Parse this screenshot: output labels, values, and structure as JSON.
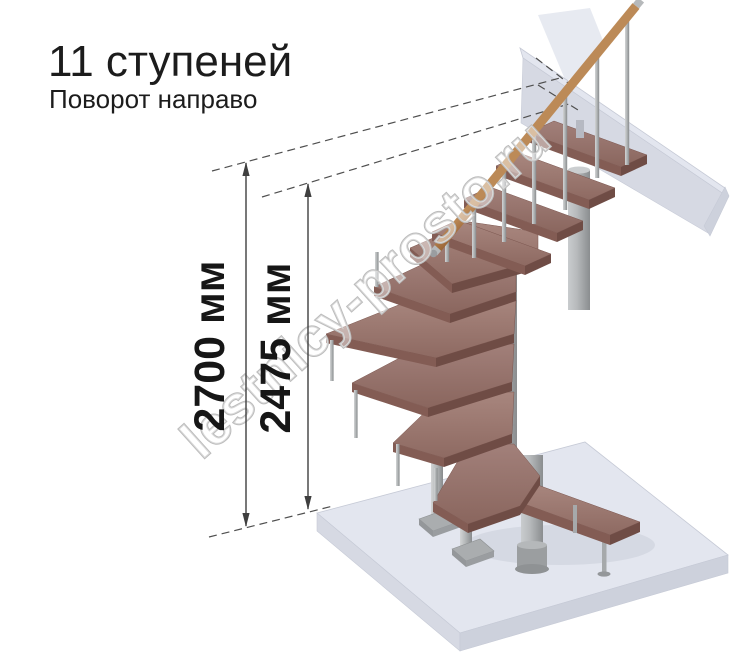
{
  "header": {
    "title": "11 ступеней",
    "subtitle": "Поворот направо"
  },
  "annotations": {
    "dimension_outer": "2700 мм",
    "dimension_inner": "2475 мм"
  },
  "watermark": "lestnicy-prosto.ru",
  "colors": {
    "wood_top": "#9a7871",
    "wood_edge": "#7d5750",
    "metal": "#b4b6b8",
    "floor_slab": "#e3e6ef",
    "annotation_line": "#3f3f3f",
    "text": "#1c1c1c",
    "watermark_outline": "#bcbcbc"
  }
}
